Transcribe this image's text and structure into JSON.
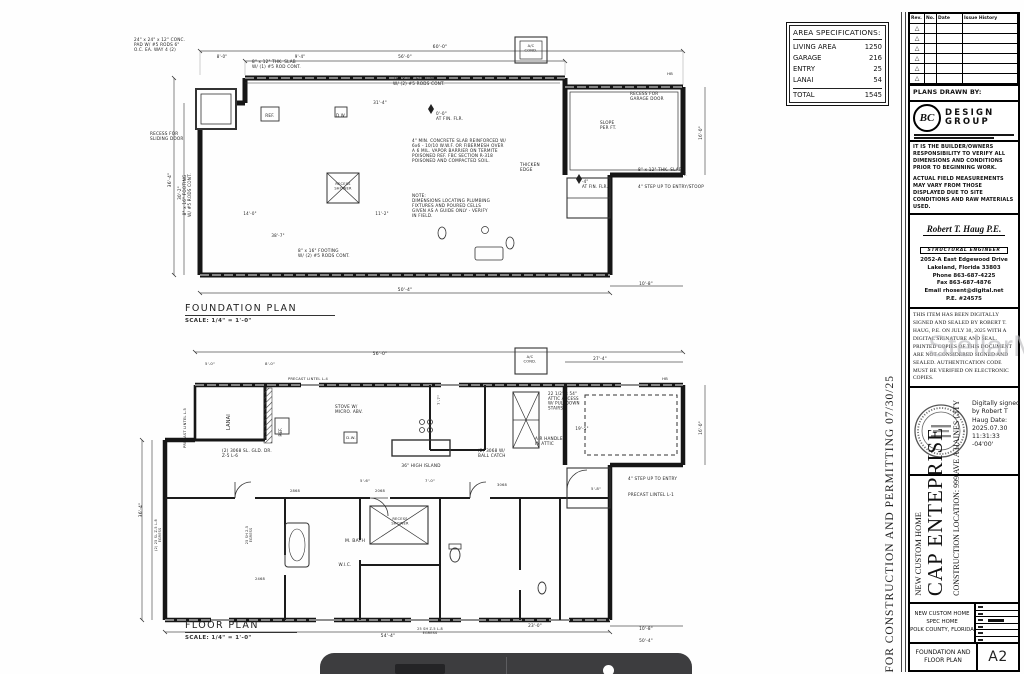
{
  "area_spec": {
    "title": "AREA SPECIFICATIONS:",
    "rows": [
      {
        "label": "LIVING AREA",
        "value": "1250"
      },
      {
        "label": "GARAGE",
        "value": "216"
      },
      {
        "label": "ENTRY",
        "value": "25"
      },
      {
        "label": "LANAI",
        "value": "54"
      }
    ],
    "total": {
      "label": "TOTAL",
      "value": "1545"
    }
  },
  "side_note": "FOR CONSTRUCTION AND PERMITTING 07/30/25",
  "watermark": "StellarMLS",
  "foundation": {
    "title": "FOUNDATION PLAN",
    "scale": "SCALE: 1/4\" = 1'-0\"",
    "labels": [
      {
        "t": "24\" x 24\" x 12\" CONC.\nPAD W/ #5 RODS 6\"\nO.C. EA. WAY 4 (2)",
        "x": 4,
        "y": 16,
        "s": 4.2,
        "a": "start"
      },
      {
        "t": "8\" x 12\" THK. SLAB\nW/ (1) #5 ROD CONT.",
        "x": 122,
        "y": 38,
        "s": 4.2,
        "a": "start"
      },
      {
        "t": "18\" x 16\" FOOTING\nW/ (2) #5 RODS CONT.",
        "x": 263,
        "y": 55,
        "s": 4.2,
        "a": "start"
      },
      {
        "t": "RECESS FOR\nSLIDING DOOR",
        "x": 20,
        "y": 110,
        "s": 4.2,
        "a": "start"
      },
      {
        "t": "8\" x 16\" FOOTING\nW/ #5 RODS CONT.",
        "x": 56,
        "y": 170,
        "s": 4.2,
        "r": -90
      },
      {
        "t": "REF.",
        "x": 140,
        "y": 92,
        "s": 4.2
      },
      {
        "t": "D.W.",
        "x": 211,
        "y": 92,
        "s": 4
      },
      {
        "t": "0'-0\"\nAT FIN. FLR.",
        "x": 306,
        "y": 90,
        "s": 4.2,
        "a": "start"
      },
      {
        "t": "4\" MIN. CONCRETE SLAB REINFORCED W/\n6x6 - 10/10 W.W.F. OR FIBERMESH OVER\nA 6 MIL. VAPOR BARRIER ON TERMITE\nPOISONED REF. FBC SECTION R-318\nPOISONED AND COMPACTED SOIL.",
        "x": 282,
        "y": 117,
        "s": 4.2,
        "a": "start"
      },
      {
        "t": "NOTE:\nDIMENSIONS LOCATING PLUMBING\nFIXTURES AND POURED CELLS\nGIVEN AS A GUIDE ONLY - VERIFY\nIN FIELD.",
        "x": 282,
        "y": 172,
        "s": 4.2,
        "a": "start"
      },
      {
        "t": "RECESS\nSHOWER",
        "x": 213,
        "y": 160,
        "s": 3.6
      },
      {
        "t": "RECESS FOR\nGARAGE DOOR",
        "x": 500,
        "y": 70,
        "s": 4.2,
        "a": "start"
      },
      {
        "t": "SLOPE\nPER FT.",
        "x": 470,
        "y": 99,
        "s": 4.2,
        "a": "start"
      },
      {
        "t": "THICKEN\nEDGE",
        "x": 390,
        "y": 141,
        "s": 4.2,
        "a": "start"
      },
      {
        "t": "8\" x 12\" THK. SLAB\nW/ (1) #5 ROD CONT.",
        "x": 508,
        "y": 146,
        "s": 4.2,
        "a": "start"
      },
      {
        "t": "4\" STEP UP TO ENTRY/STOOP",
        "x": 508,
        "y": 163,
        "s": 4.2,
        "a": "start"
      },
      {
        "t": "-4\"\nAT FIN. FLR.",
        "x": 452,
        "y": 158,
        "s": 4,
        "a": "start"
      },
      {
        "t": "A/C\nCOND.",
        "x": 401,
        "y": 22,
        "s": 3.6
      },
      {
        "t": "8\" x 16\" FOOTING\nW/ (2) #5 RODS CONT.",
        "x": 168,
        "y": 227,
        "s": 4.2,
        "a": "start"
      },
      {
        "t": "HB",
        "x": 540,
        "y": 50,
        "s": 3.8
      },
      {
        "t": "60'-0\"",
        "x": 310,
        "y": 23,
        "s": 4.5
      },
      {
        "t": "56'-0\"",
        "x": 275,
        "y": 33,
        "s": 4.2
      },
      {
        "t": "8'-0\"",
        "x": 92,
        "y": 33,
        "s": 4
      },
      {
        "t": "9'-4\"",
        "x": 170,
        "y": 33,
        "s": 4
      },
      {
        "t": "31'-4\"",
        "x": 250,
        "y": 79,
        "s": 4.2
      },
      {
        "t": "36'-4\"",
        "x": 41,
        "y": 155,
        "s": 4.5,
        "r": -90
      },
      {
        "t": "30'-2\"",
        "x": 51,
        "y": 168,
        "s": 4.2,
        "r": -90
      },
      {
        "t": "16'-0\"",
        "x": 572,
        "y": 108,
        "s": 4.2,
        "r": -90
      },
      {
        "t": "50'-4\"",
        "x": 275,
        "y": 266,
        "s": 4.5
      },
      {
        "t": "10'-8\"",
        "x": 516,
        "y": 260,
        "s": 4.2
      },
      {
        "t": "14'-0\"",
        "x": 120,
        "y": 190,
        "s": 4
      },
      {
        "t": "38'-7\"",
        "x": 148,
        "y": 212,
        "s": 4
      },
      {
        "t": "11'-2\"",
        "x": 252,
        "y": 190,
        "s": 4
      }
    ]
  },
  "floor": {
    "title": "FLOOR PLAN",
    "scale": "SCALE: 1/4\" = 1'-0\"",
    "labels": [
      {
        "t": "LANAI",
        "x": 100,
        "y": 82,
        "s": 5,
        "r": -90
      },
      {
        "t": "PRECAST LINTEL L-5",
        "x": 56,
        "y": 88,
        "s": 3.6,
        "r": -90
      },
      {
        "t": "PRECAST LINTEL L-4",
        "x": 178,
        "y": 40,
        "s": 3.6
      },
      {
        "t": "(2) 3068 SL. GLD. DR.\nZ-5  L-6",
        "x": 92,
        "y": 112,
        "s": 4.2,
        "a": "start"
      },
      {
        "t": "STOVE W/\nMICRO. ABV.",
        "x": 205,
        "y": 68,
        "s": 4.2,
        "a": "start"
      },
      {
        "t": "REF.",
        "x": 152,
        "y": 92,
        "s": 4,
        "r": -90
      },
      {
        "t": "D.W.",
        "x": 221,
        "y": 99,
        "s": 3.8
      },
      {
        "t": "36\" HIGH ISLAND",
        "x": 291,
        "y": 127,
        "s": 4.2
      },
      {
        "t": "22 1/2\" x 54\"\nATTIC ACCESS\nW/ PULLDOWN\nSTAIRS",
        "x": 418,
        "y": 55,
        "s": 4,
        "a": "start"
      },
      {
        "t": "AIR HANDLER\nIN ATTIC",
        "x": 405,
        "y": 100,
        "s": 4.2,
        "a": "start"
      },
      {
        "t": "(2) 3068 W/\nBALL CATCH",
        "x": 348,
        "y": 112,
        "s": 4.2,
        "a": "start"
      },
      {
        "t": "4\" STEP UP TO ENTRY",
        "x": 498,
        "y": 140,
        "s": 4.2,
        "a": "start"
      },
      {
        "t": "PRECAST LINTEL L-1",
        "x": 498,
        "y": 156,
        "s": 4.2,
        "a": "start"
      },
      {
        "t": "M. BATH",
        "x": 225,
        "y": 202,
        "s": 4.5
      },
      {
        "t": "W.I.C.",
        "x": 215,
        "y": 226,
        "s": 4.2
      },
      {
        "t": "RECESS\nSHOWER",
        "x": 270,
        "y": 180,
        "s": 3.6
      },
      {
        "t": "A/C\nCOND.",
        "x": 400,
        "y": 18,
        "s": 3.6
      },
      {
        "t": "HB",
        "x": 535,
        "y": 40,
        "s": 3.8
      },
      {
        "t": "2868",
        "x": 165,
        "y": 152,
        "s": 3.6
      },
      {
        "t": "2068",
        "x": 250,
        "y": 152,
        "s": 3.6
      },
      {
        "t": "3068",
        "x": 372,
        "y": 146,
        "s": 3.6
      },
      {
        "t": "2468",
        "x": 130,
        "y": 240,
        "s": 3.6
      },
      {
        "t": "25 SH Z-5 L-8\nEGRESS",
        "x": 300,
        "y": 290,
        "s": 3.4
      },
      {
        "t": "(2) 25 SL Z-5 L-8\nEGRESS",
        "x": 27,
        "y": 195,
        "s": 3.4,
        "r": -90
      },
      {
        "t": "25 SH 2-5\nEGRESS",
        "x": 118,
        "y": 195,
        "s": 3.4,
        "r": -90
      },
      {
        "t": "56'-0\"",
        "x": 250,
        "y": 15,
        "s": 4.5
      },
      {
        "t": "27'-4\"",
        "x": 470,
        "y": 20,
        "s": 4.2
      },
      {
        "t": "5'-0\"",
        "x": 80,
        "y": 25,
        "s": 3.8
      },
      {
        "t": "8'-0\"",
        "x": 140,
        "y": 25,
        "s": 3.8
      },
      {
        "t": "36'-4\"",
        "x": 12,
        "y": 170,
        "s": 4.5,
        "r": -90
      },
      {
        "t": "54'-4\"",
        "x": 258,
        "y": 297,
        "s": 4.5
      },
      {
        "t": "23'-0\"",
        "x": 405,
        "y": 287,
        "s": 4.2
      },
      {
        "t": "10'-8\"",
        "x": 516,
        "y": 290,
        "s": 4.2
      },
      {
        "t": "50'-4\"",
        "x": 516,
        "y": 302,
        "s": 4.2
      },
      {
        "t": "19'-5\"",
        "x": 452,
        "y": 90,
        "s": 4
      },
      {
        "t": "5'-8\"",
        "x": 466,
        "y": 150,
        "s": 3.8
      },
      {
        "t": "5'-6\"",
        "x": 235,
        "y": 142,
        "s": 3.8
      },
      {
        "t": "7'-0\"",
        "x": 300,
        "y": 142,
        "s": 3.8
      },
      {
        "t": "16'-0\"",
        "x": 572,
        "y": 88,
        "s": 4.2,
        "r": -90
      },
      {
        "t": "7'-7\"",
        "x": 310,
        "y": 60,
        "s": 3.8,
        "r": -90
      }
    ]
  },
  "titleblock": {
    "revisions": {
      "headers": [
        "Rev.",
        "No.",
        "Date",
        "Issue History"
      ]
    },
    "plans_drawn_by": "PLANS DRAWN BY:",
    "logo": {
      "monogram": "BC",
      "name_line1": "DESIGN",
      "name_line2": "GROUP"
    },
    "disclaimer1": "IT IS THE BUILDER/OWNERS RESPONSIBILITY TO VERIFY ALL DIMENSIONS AND CONDITIONS PRIOR TO BEGINNING WORK.",
    "disclaimer2": "ACTUAL FIELD MEASUREMENTS MAY VARY FROM THOSE DISPLAYED DUE TO SITE CONDITIONS AND RAW MATERIALS USED.",
    "engineer": {
      "name": "Robert T. Haug P.E.",
      "title": "STRUCTURAL ENGINEER",
      "address1": "2052-A East Edgewood Drive",
      "address2": "Lakeland, Florida  33803",
      "phone": "Phone 863-687-4225",
      "fax": "Fax 863-687-4876",
      "email": "Email rhosent@digital.net",
      "license": "P.E. #24575"
    },
    "signing_statement": "THIS ITEM HAS BEEN DIGITALLY SIGNED AND SEALED BY ROBERT T. HAUG, P.E. ON JULY 30, 2025 WITH A DIGITAL SIGNATURE AND SEAL.  PRINTED COPIES OF THIS DOCUMENT ARE NOT CONSIDERED SIGNED AND SEALED.  AUTHENTICATION CODE MUST BE VERIFIED ON ELECTRONIC COPIES.",
    "digital_signature": "Digitally signed by Robert T Haug Date: 2025.07.30 11:31:33 -04'00'",
    "project": {
      "type": "NEW CUSTOM HOME",
      "client": "CAP ENTEPRISE",
      "location": "CONSTRUCTION LOCATION:  999 AVE A HAINES CITY"
    },
    "footer": {
      "line1": "NEW CUSTOM HOME",
      "line2": "SPEC HOME",
      "line3": "POLK COUNTY, FLORIDA",
      "sheet_title": "FOUNDATION AND FLOOR PLAN",
      "sheet_no": "A2"
    }
  }
}
